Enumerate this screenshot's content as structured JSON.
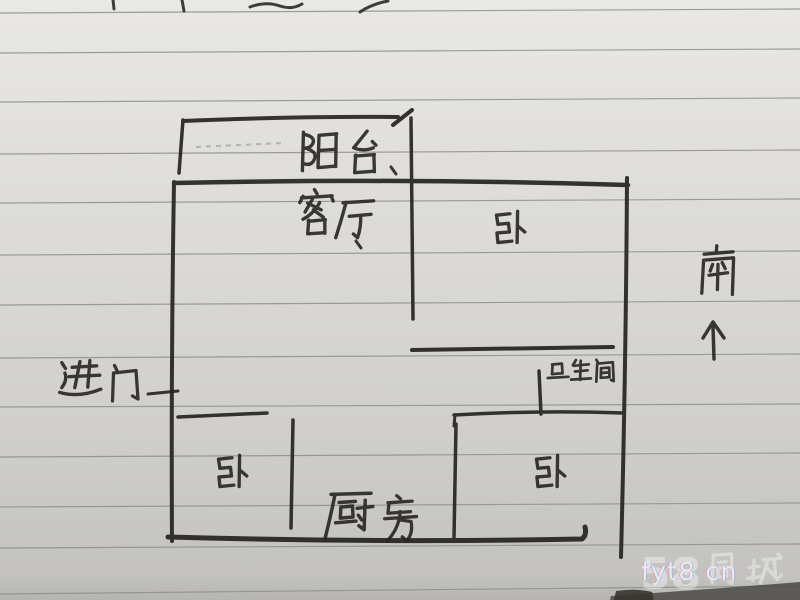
{
  "floor_plan": {
    "balcony_label": "阳台",
    "living_room_label": "客厅",
    "bedroom_top_right_label": "卧",
    "bathroom_label": "卫生间",
    "bedroom_bottom_left_label": "卧",
    "kitchen_label": "厨房",
    "bedroom_bottom_right_label": "卧",
    "entrance_label": "进门",
    "entrance_arrow_direction": "right",
    "south_label": "南",
    "south_arrow_direction": "up"
  },
  "watermark": {
    "id_text": "fyt8 cn",
    "brand_number": "58",
    "brand_text": "58同城"
  },
  "colors": {
    "paper": "#dcdbd7",
    "ink": "#26241f",
    "rule_line": "#8f8f8b",
    "watermark_front": "#e6f1fb"
  }
}
